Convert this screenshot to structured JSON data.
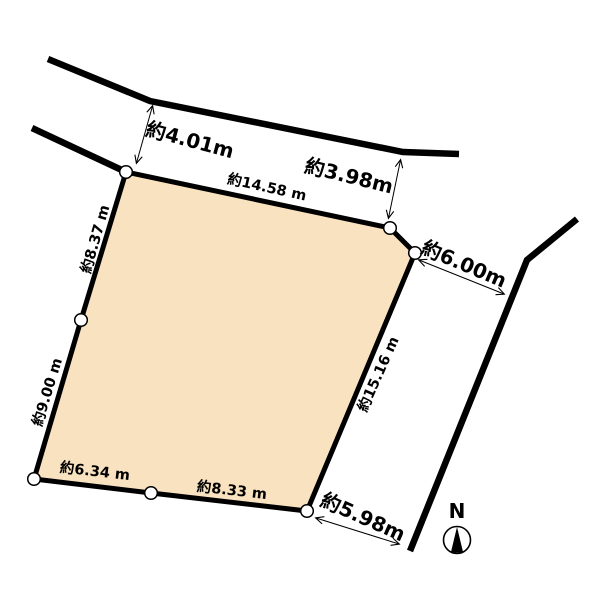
{
  "diagram": {
    "kind": "land-plot-survey-diagram",
    "colors": {
      "plot_fill": "#F9E2BF",
      "line": "#000000",
      "background": "#FFFFFF"
    },
    "plot_edge_labels": {
      "top": "約14.58 m",
      "left_upper": "約8.37 m",
      "left_lower": "約9.00 m",
      "right": "約15.16 m",
      "bottom_left": "約6.34 m",
      "bottom_right": "約8.33 m"
    },
    "road_measurements": {
      "north_road_width": "約4.01m",
      "northeast_gap": "約3.98m",
      "east_gap_upper": "約6.00m",
      "east_gap_lower": "約5.98m"
    },
    "compass": {
      "north_label": "N"
    }
  }
}
